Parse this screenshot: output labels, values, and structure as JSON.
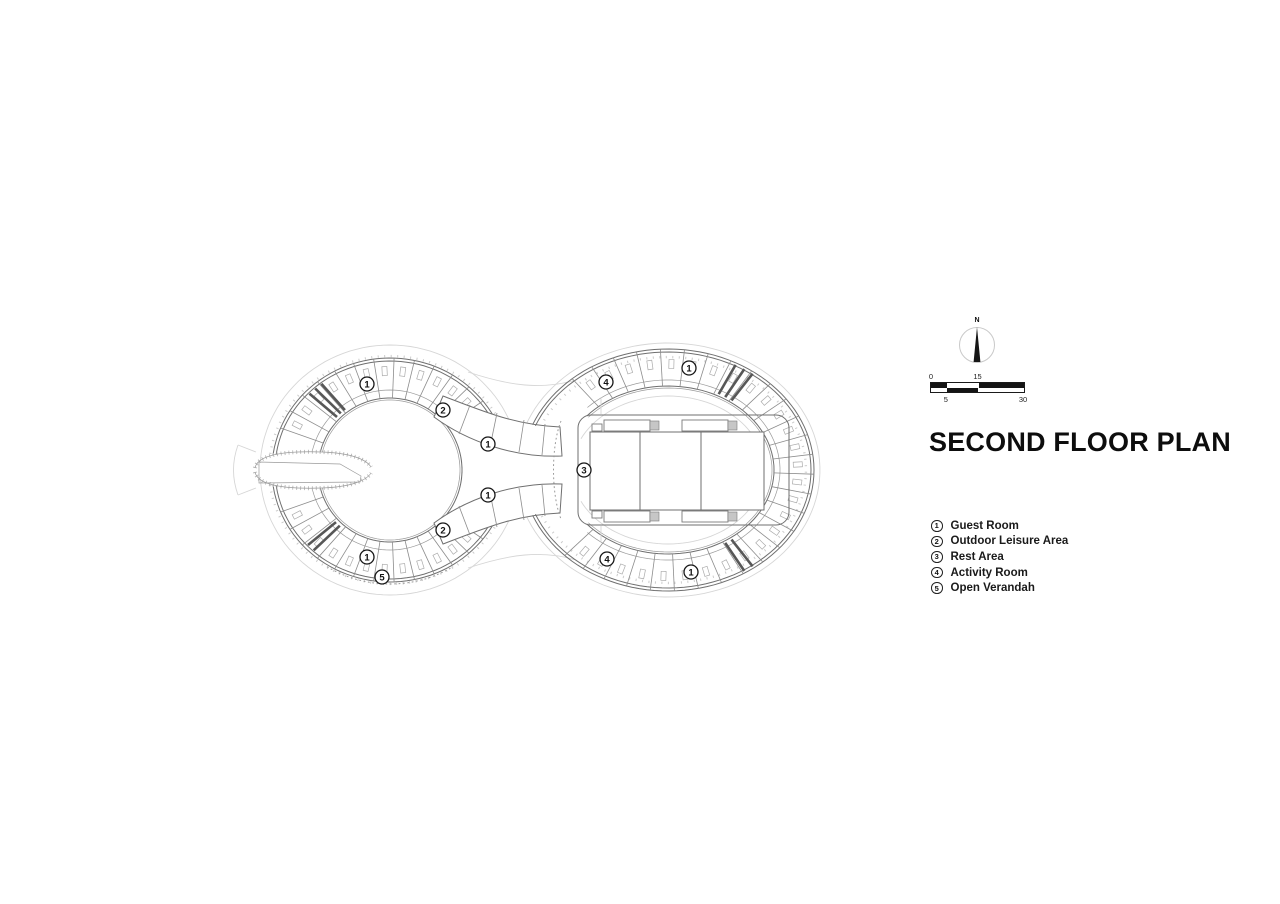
{
  "title": "SECOND FLOOR PLAN",
  "north": {
    "label": "N"
  },
  "scale_bar": {
    "n0": "0",
    "n15": "15",
    "n5": "5",
    "n30": "30"
  },
  "legend": {
    "items": [
      {
        "num": "1",
        "label": "Guest Room"
      },
      {
        "num": "2",
        "label": "Outdoor Leisure Area"
      },
      {
        "num": "3",
        "label": "Rest Area"
      },
      {
        "num": "4",
        "label": "Activity Room"
      },
      {
        "num": "5",
        "label": "Open Verandah"
      }
    ]
  },
  "plan": {
    "markers": [
      {
        "num": "1",
        "x": 367,
        "y": 384
      },
      {
        "num": "2",
        "x": 443,
        "y": 410
      },
      {
        "num": "1",
        "x": 488,
        "y": 444
      },
      {
        "num": "4",
        "x": 606,
        "y": 382
      },
      {
        "num": "1",
        "x": 689,
        "y": 368
      },
      {
        "num": "3",
        "x": 584,
        "y": 470
      },
      {
        "num": "1",
        "x": 488,
        "y": 495
      },
      {
        "num": "2",
        "x": 443,
        "y": 530
      },
      {
        "num": "1",
        "x": 367,
        "y": 557
      },
      {
        "num": "5",
        "x": 382,
        "y": 577
      },
      {
        "num": "4",
        "x": 607,
        "y": 559
      },
      {
        "num": "1",
        "x": 691,
        "y": 572
      }
    ]
  },
  "colors": {
    "ink": "#111111",
    "wall": "#6f6f6f",
    "faint": "#d6d6d6"
  }
}
